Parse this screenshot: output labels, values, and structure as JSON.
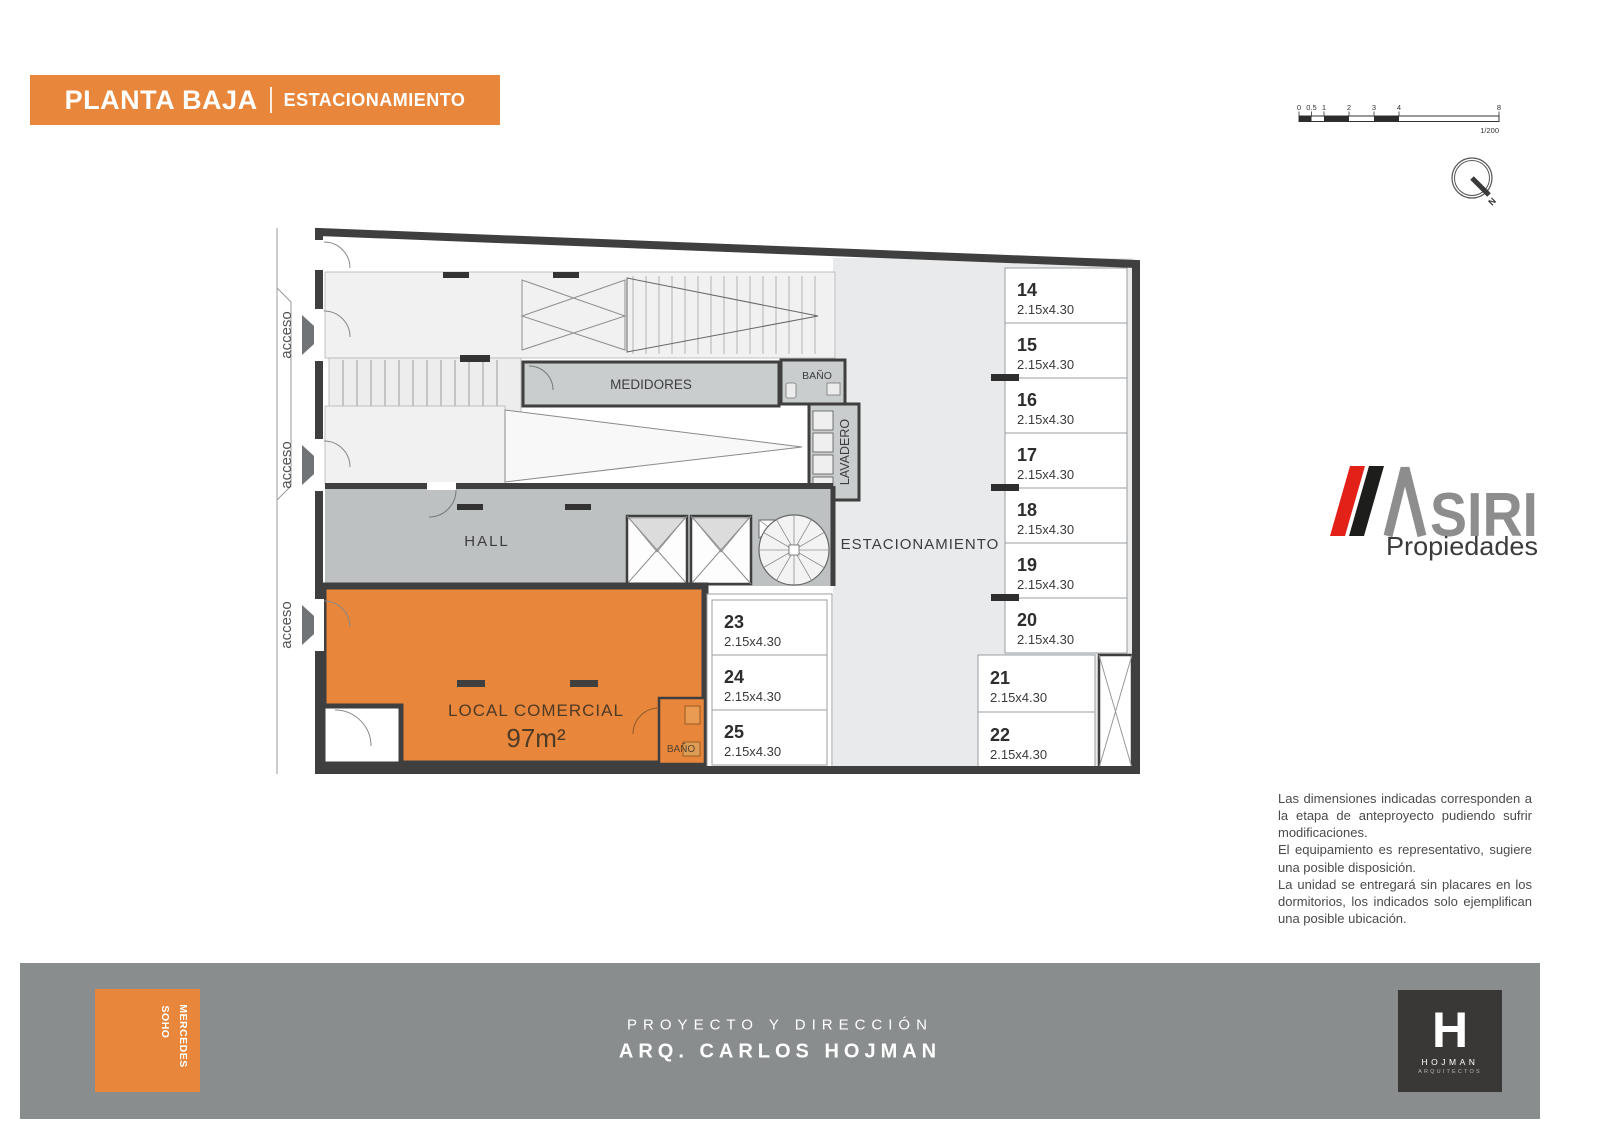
{
  "banner": {
    "main": "PLANTA BAJA",
    "sub": "ESTACIONAMIENTO"
  },
  "scalebar": {
    "ticks": [
      "0",
      "0.5",
      "1",
      "2",
      "3",
      "4",
      "8"
    ],
    "ratio": "1/200"
  },
  "compass": {
    "north": "N"
  },
  "plan": {
    "access_labels": [
      "acceso",
      "acceso",
      "acceso"
    ],
    "rooms": {
      "medidores": "MEDIDORES",
      "bano_top": "BAÑO",
      "lavadero": "LAVADERO",
      "hall": "HALL",
      "estacionamiento": "ESTACIONAMIENTO",
      "local_comercial": "LOCAL COMERCIAL",
      "local_area": "97m²",
      "bano_local": "BAÑO"
    },
    "spots": [
      {
        "number": "14",
        "size": "2.15x4.30"
      },
      {
        "number": "15",
        "size": "2.15x4.30"
      },
      {
        "number": "16",
        "size": "2.15x4.30"
      },
      {
        "number": "17",
        "size": "2.15x4.30"
      },
      {
        "number": "18",
        "size": "2.15x4.30"
      },
      {
        "number": "19",
        "size": "2.15x4.30"
      },
      {
        "number": "20",
        "size": "2.15x4.30"
      },
      {
        "number": "21",
        "size": "2.15x4.30"
      },
      {
        "number": "22",
        "size": "2.15x4.30"
      },
      {
        "number": "23",
        "size": "2.15x4.30"
      },
      {
        "number": "24",
        "size": "2.15x4.30"
      },
      {
        "number": "25",
        "size": "2.15x4.30"
      }
    ]
  },
  "logo": {
    "name": "SIRI",
    "tagline": "Propiedades"
  },
  "disclaimer": {
    "p1": "Las dimensiones indicadas corresponden a la etapa de anteproyecto pudiendo sufrir modificaciones.",
    "p2": "El equipamiento es representativo, sugiere una posible disposición.",
    "p3": "La unidad se entregará sin placares en los dormitorios, los indicados solo ejemplifican una posible ubicación."
  },
  "footer": {
    "project_label": "PROYECTO Y DIRECCIÓN",
    "architect": "ARQ. CARLOS HOJMAN",
    "soho_line1": "SOHO",
    "soho_line2": "MERCEDES",
    "hojman_letter": "H",
    "hojman_name": "HOJMAN",
    "hojman_sub": "ARQUITECTOS"
  },
  "colors": {
    "accent_orange": "#E8873B",
    "wall_dark": "#3F3F3F",
    "footer_gray": "#8A8D8E",
    "logo_red": "#E32119",
    "logo_black": "#1D1D1B",
    "logo_gray": "#8D8D8D"
  }
}
